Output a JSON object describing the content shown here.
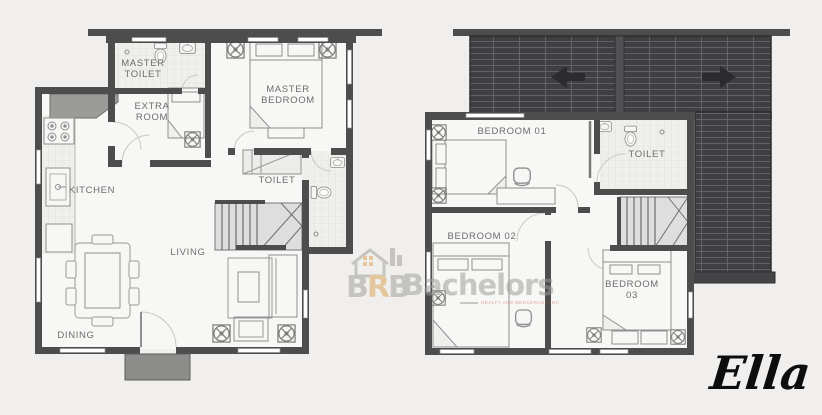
{
  "floor_plan": {
    "unit_name": "Ella",
    "ground_floor": {
      "labels": {
        "master_toilet": "MASTER TOILET",
        "extra_room": "EXTRA ROOM",
        "master_bedroom": "MASTER BEDROOM",
        "kitchen": "KITCHEN",
        "toilet": "TOILET",
        "living": "LIVING",
        "dining": "DINING"
      }
    },
    "second_floor": {
      "labels": {
        "bedroom_01": "BEDROOM 01",
        "toilet": "TOILET",
        "bedroom_02": "BEDROOM 02",
        "bedroom_03": "BEDROOM 03"
      }
    }
  },
  "watermark": {
    "letter_1": "B",
    "letter_2": "R",
    "letter_3": "B",
    "letters_sub": "inc",
    "brand": "Bachelors",
    "tagline": "REALTY AND BROKERAGE INC"
  },
  "colors": {
    "background": "#f0efee",
    "wall": "#4d4d4d",
    "roof": "#3f3f42",
    "accent_orange": "#d9a253",
    "tagline_red": "#c1574a",
    "label_gray": "#6d6d6d",
    "script_black": "#0d0d0d"
  }
}
